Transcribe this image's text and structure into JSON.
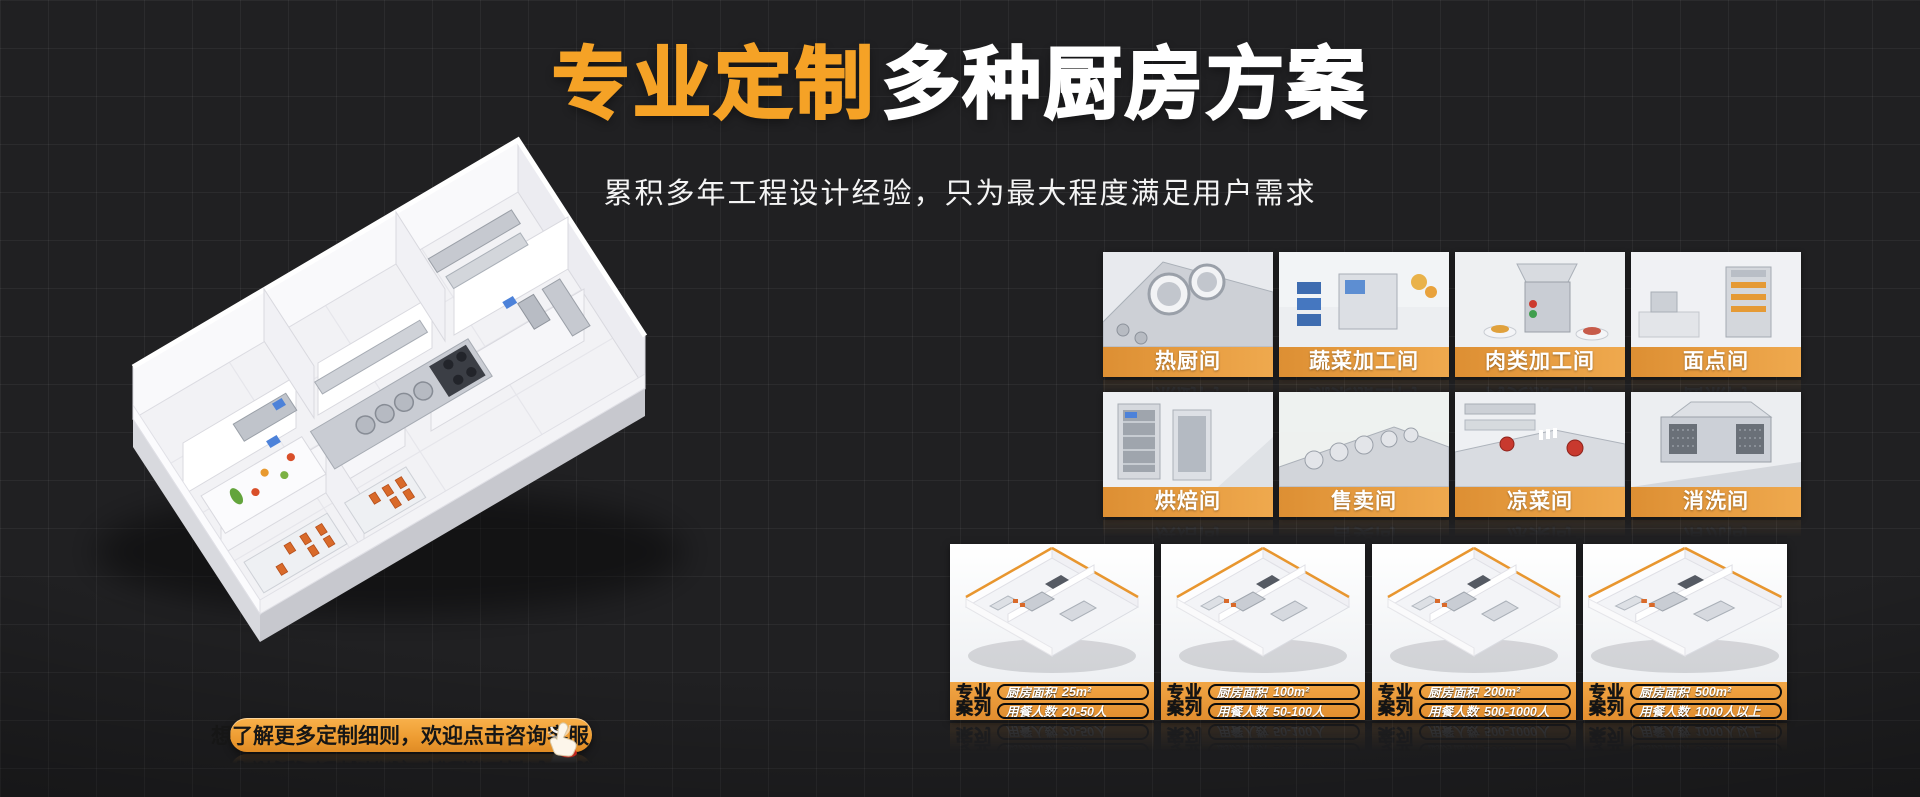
{
  "page": {
    "background": "#202022"
  },
  "colors": {
    "accent_orange": "#F5A226",
    "tile_banner_orange": "#E8993E",
    "card_banner_orange": "#E6953A",
    "button_orange": "#EE9D33",
    "tray_orange": "#D96A2A",
    "screen_blue": "#4D82D9"
  },
  "header": {
    "title_highlight": "专业定制",
    "title_rest": "多种厨房方案",
    "subtitle": "累积多年工程设计经验，只为最大程度满足用户需求"
  },
  "cta": {
    "label": "想了解更多定制细则，欢迎点击咨询客服"
  },
  "rooms": {
    "items": [
      {
        "label": "热厨间"
      },
      {
        "label": "蔬菜加工间"
      },
      {
        "label": "肉类加工间"
      },
      {
        "label": "面点间"
      },
      {
        "label": "烘焙间"
      },
      {
        "label": "售卖间"
      },
      {
        "label": "凉菜间"
      },
      {
        "label": "消洗间"
      }
    ]
  },
  "cases": {
    "badge_line1": "专业",
    "badge_line2": "案列",
    "items": [
      {
        "area_label": "厨房面积",
        "area_value": "25m²",
        "diners_label": "用餐人数",
        "diners_value": "20-50人"
      },
      {
        "area_label": "厨房面积",
        "area_value": "100m²",
        "diners_label": "用餐人数",
        "diners_value": "50-100人"
      },
      {
        "area_label": "厨房面积",
        "area_value": "200m²",
        "diners_label": "用餐人数",
        "diners_value": "500-1000人"
      },
      {
        "area_label": "厨房面积",
        "area_value": "500m²",
        "diners_label": "用餐人数",
        "diners_value": "1000人以上"
      }
    ]
  }
}
